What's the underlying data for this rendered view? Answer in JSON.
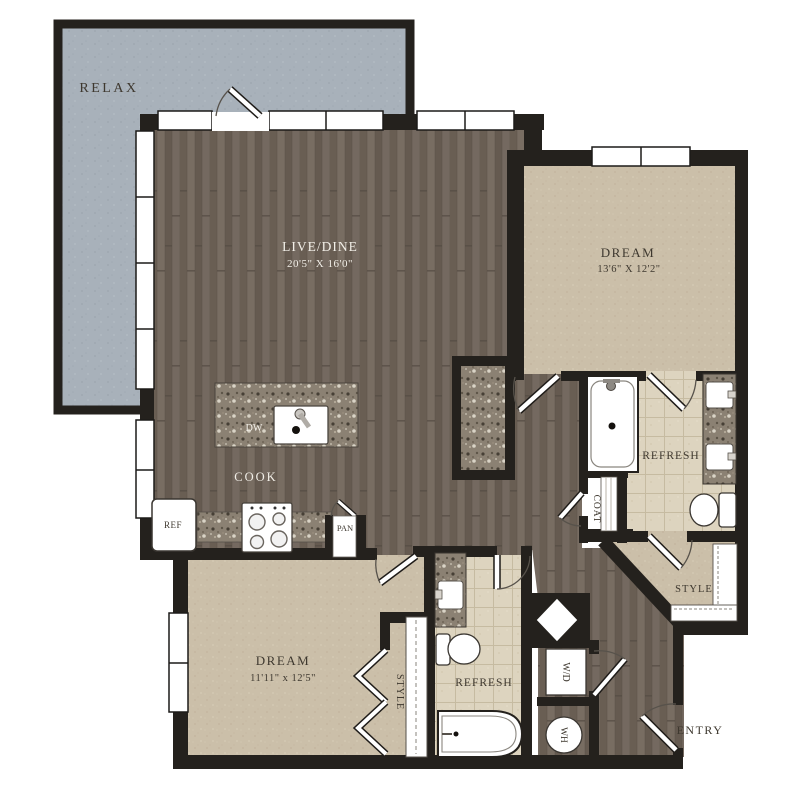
{
  "plan": {
    "balcony": {
      "label": "RELAX"
    },
    "living": {
      "label": "LIVE/DINE",
      "dims": "20'5\" X 16'0\""
    },
    "bedroom1": {
      "label": "DREAM",
      "dims": "13'6\" X 12'2\""
    },
    "bedroom2": {
      "label": "DREAM",
      "dims": "11'11\" x 12'5\""
    },
    "bath1": {
      "label": "REFRESH"
    },
    "bath2": {
      "label": "REFRESH"
    },
    "closet1": {
      "label": "STYLE"
    },
    "closet2": {
      "label": "STYLE"
    },
    "coat": {
      "label": "COAT"
    },
    "kitchen": {
      "label": "COOK",
      "dishwasher": "DW",
      "refrigerator": "REF",
      "pantry": "PAN"
    },
    "laundry": {
      "washer_dryer": "W/D",
      "water_heater": "WH"
    },
    "entry": {
      "label": "ENTRY"
    },
    "colors": {
      "wall": "#24211d",
      "wood": "#6f6459",
      "carpet": "#cbbfa9",
      "tile": "#ddd4bf",
      "granite": "#8b8173",
      "balcony": "#a8b1ba",
      "fixture": "#ffffff",
      "label_dark": "#3e382f",
      "label_light": "#f2efe8"
    }
  }
}
